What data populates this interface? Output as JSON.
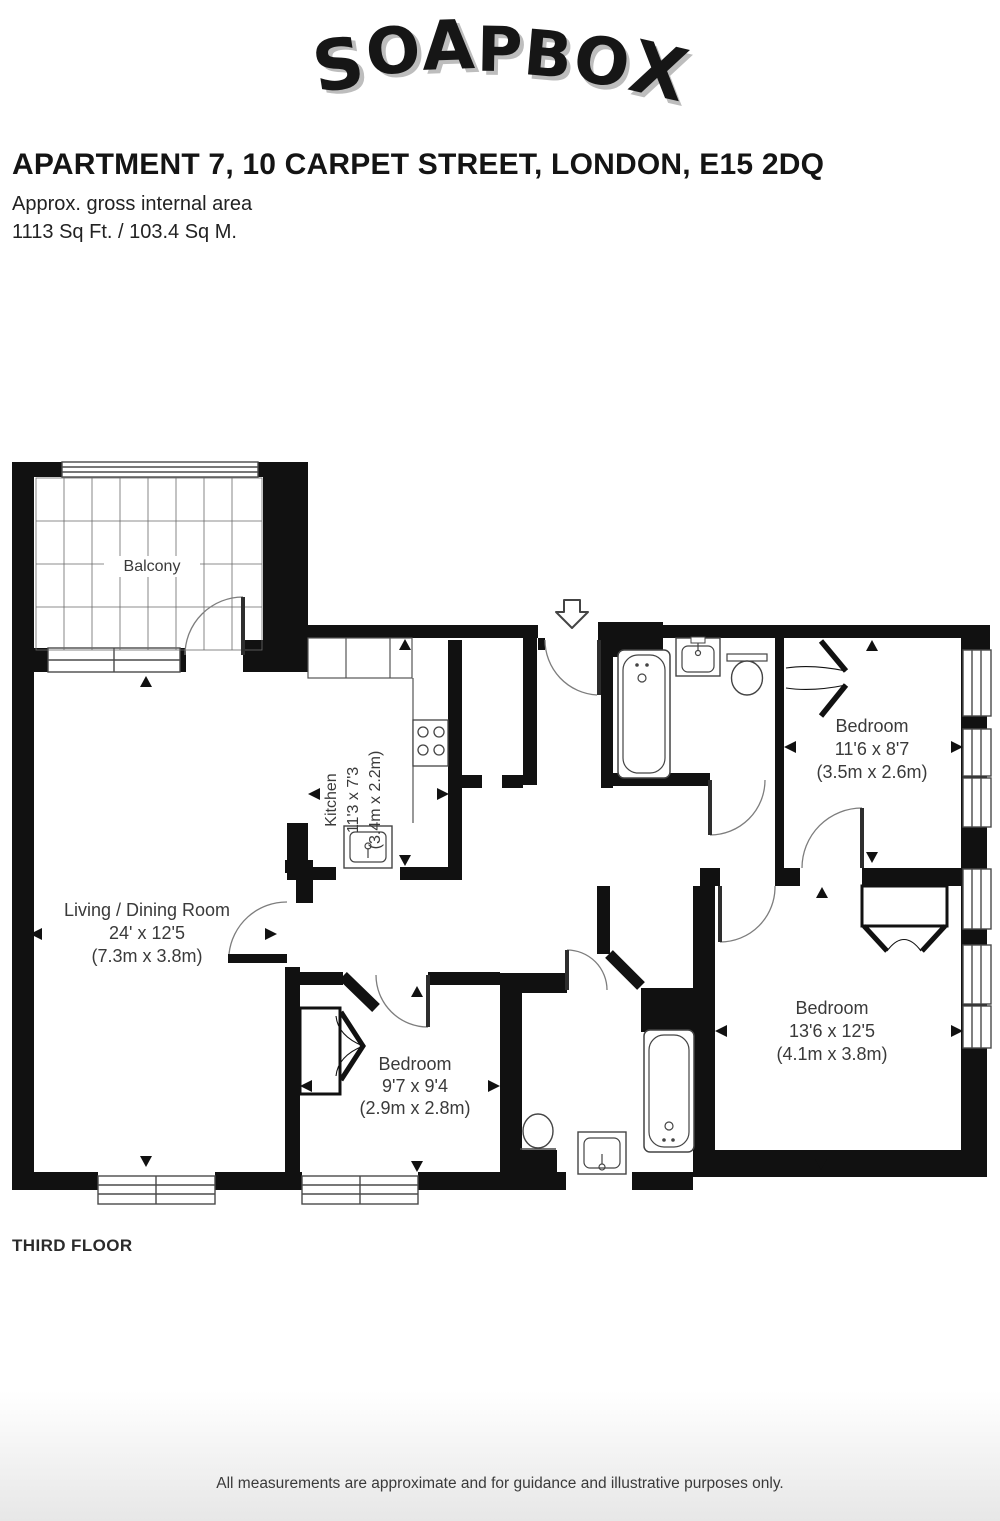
{
  "header": {
    "logo": "SOAPBOX",
    "title": "APARTMENT 7, 10 CARPET STREET, LONDON, E15 2DQ",
    "area_label": "Approx. gross internal area",
    "area_value": "1113 Sq Ft. / 103.4 Sq M."
  },
  "floorplan": {
    "floor_label": "THIRD FLOOR",
    "rooms": [
      {
        "name": "Balcony",
        "imperial": "",
        "metric": ""
      },
      {
        "name": "Kitchen",
        "imperial": "11'3 x 7'3",
        "metric": "(3.4m x 2.2m)"
      },
      {
        "name": "Living / Dining Room",
        "imperial": "24' x 12'5",
        "metric": "(7.3m x 3.8m)"
      },
      {
        "name": "Bedroom",
        "imperial": "11'6 x 8'7",
        "metric": "(3.5m x 2.6m)"
      },
      {
        "name": "Bedroom",
        "imperial": "9'7 x 9'4",
        "metric": "(2.9m x 2.8m)"
      },
      {
        "name": "Bedroom",
        "imperial": "13'6 x 12'5",
        "metric": "(4.1m x 3.8m)"
      }
    ]
  },
  "footer": {
    "disclaimer": "All measurements are approximate and for guidance and illustrative purposes only."
  },
  "colors": {
    "wall": "#111111",
    "label": "#3a3a3a",
    "logo_shadow": "#bdbdbd"
  }
}
